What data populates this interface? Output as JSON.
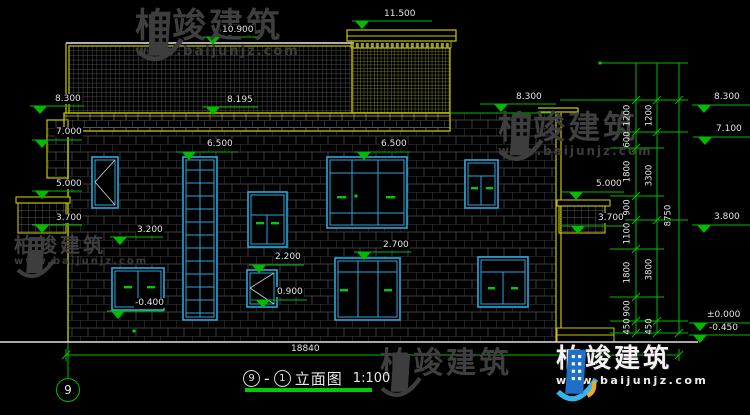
{
  "watermark": {
    "brand": "柏竣建筑",
    "url": "www.baijunjz.com"
  },
  "title": {
    "axis_a": "9",
    "dash": "-",
    "axis_b": "1",
    "name": "立面图",
    "scale": "1:100"
  },
  "axis": {
    "label": "9"
  },
  "dims": {
    "overall_width": "18840",
    "overall_height": "8750",
    "inner": [
      "1200",
      "600",
      "1800",
      "900",
      "1100",
      "1800",
      "900",
      "450"
    ],
    "outer": [
      "1200",
      "3300",
      "3800",
      "450"
    ]
  },
  "levels": {
    "tower_top": "11.500",
    "ridge": "10.900",
    "eave_left": "8.300",
    "eave_mid": "8.195",
    "eave_inner_right": "8.300",
    "left_7000": "7.000",
    "left_5000": "5.000",
    "left_3700": "3.700",
    "floor2_left": "6.500",
    "floor2_right": "6.500",
    "sill_3200": "3.200",
    "win_2200": "2.200",
    "win_0900": "0.900",
    "floor1_2700": "2.700",
    "terrace_m0400": "-0.400",
    "rbalc_5000": "5.000",
    "rbalc_3700": "3.700",
    "right_8300": "8.300",
    "right_7100": "7.100",
    "right_3800": "3.800",
    "right_0000": "±0.000",
    "right_m0450": "-0.450"
  },
  "colors": {
    "background": "#000000",
    "cad_yellow": "#c8c800",
    "dim_green": "#00bb00",
    "window_cyan": "#2aa9dd",
    "text": "#e4e4e4",
    "brand_blue": "#1e6fc8",
    "watermark_gray": "#3f3f3f"
  }
}
